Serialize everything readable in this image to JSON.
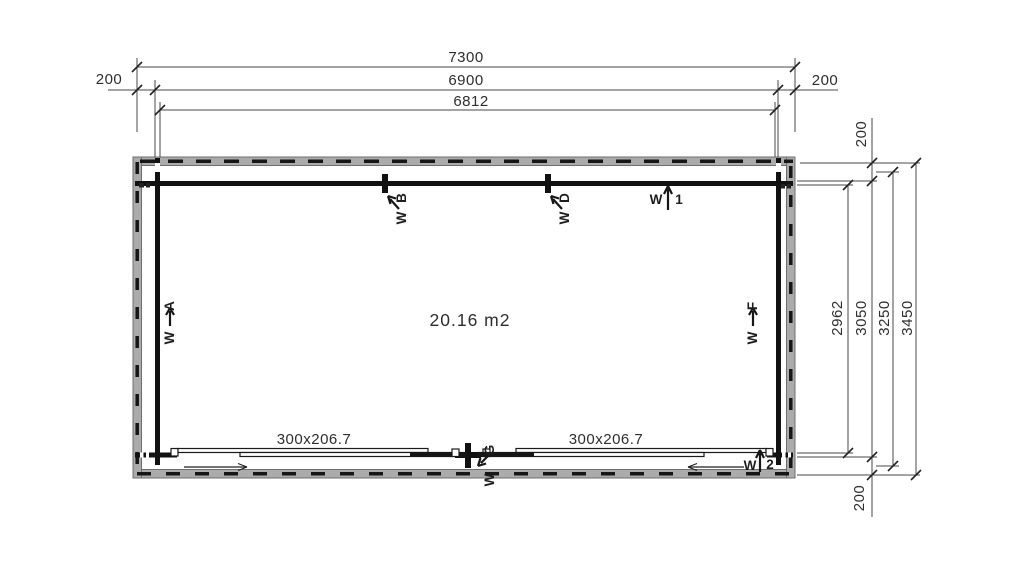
{
  "plan": {
    "area": "20.16 m2",
    "top_dims": {
      "overall": "7300",
      "mid": "6900",
      "inner": "6812",
      "left_offset": "200",
      "right_offset": "200"
    },
    "right_dims": {
      "inner": "2962",
      "mid": "3050",
      "outer_mid": "3250",
      "overall": "3450",
      "top_offset": "200",
      "bottom_offset": "200"
    },
    "doors": {
      "left_size": "300x206.7",
      "right_size": "300x206.7"
    },
    "labels": {
      "wa": {
        "w": "W",
        "id": "A"
      },
      "wb": {
        "w": "W",
        "id": "B"
      },
      "wd": {
        "w": "W",
        "id": "D"
      },
      "w1": {
        "w": "W",
        "id": "1"
      },
      "wf": {
        "w": "W",
        "id": "F"
      },
      "wg": {
        "w": "W",
        "id": "G"
      },
      "w2": {
        "w": "W",
        "id": "2"
      }
    },
    "colors": {
      "wall": "#111111",
      "log_band": "#ababab",
      "dim_line": "#4a4a4a",
      "text": "#2e2e2e"
    }
  }
}
